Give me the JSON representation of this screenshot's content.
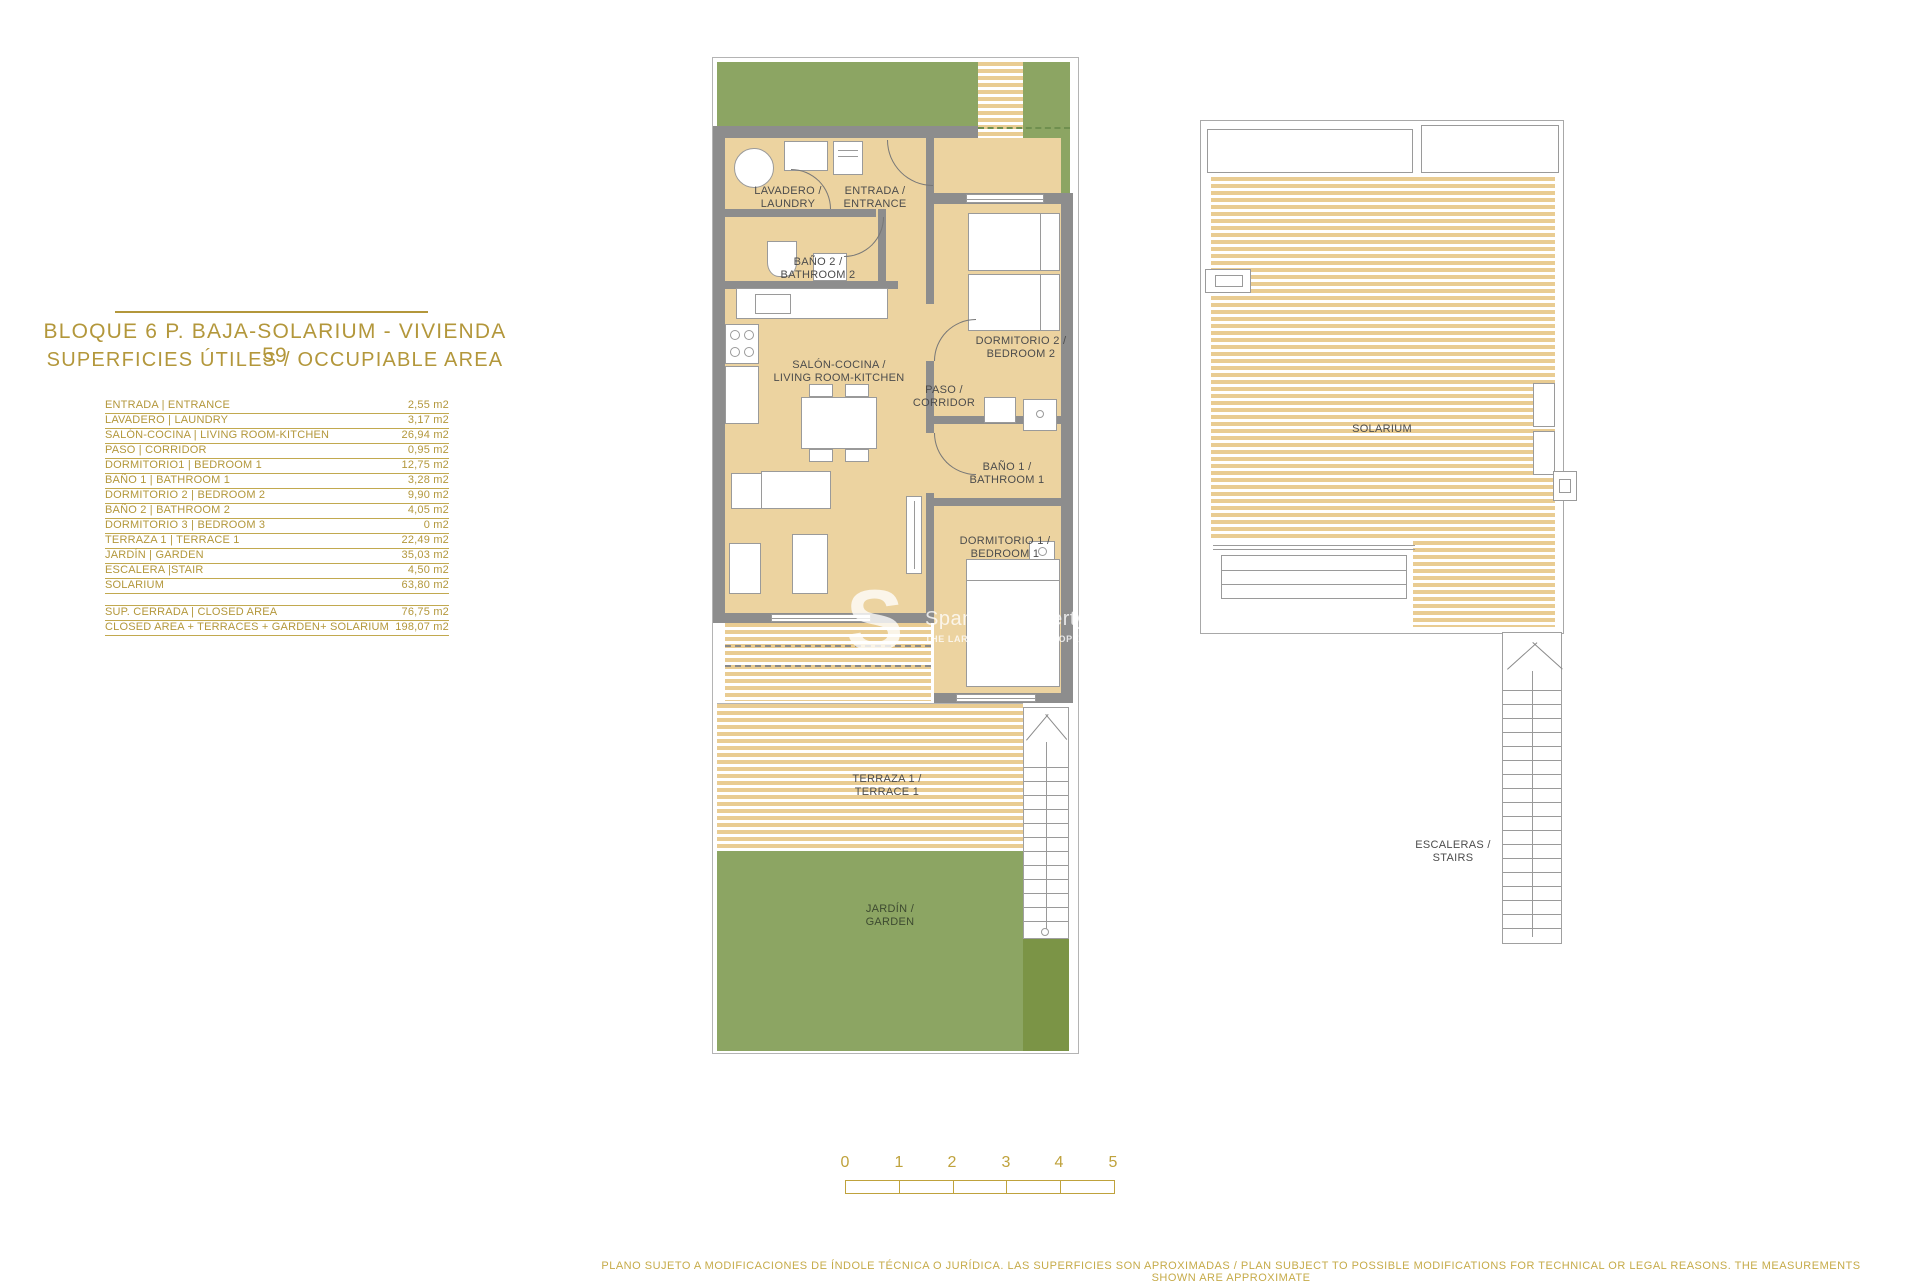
{
  "title_block": {
    "line1": "BLOQUE 6 P. BAJA-SOLARIUM - VIVIENDA 59",
    "line2": "SUPERFICIES ÚTILES / OCCUPIABLE AREA"
  },
  "area_table": {
    "rows": [
      {
        "label": "ENTRADA | ENTRANCE",
        "value": "2,55 m2"
      },
      {
        "label": "LAVADERO | LAUNDRY",
        "value": "3,17 m2"
      },
      {
        "label": "SALÓN-COCINA | LIVING ROOM-KITCHEN",
        "value": "26,94 m2"
      },
      {
        "label": "PASO | CORRIDOR",
        "value": "0,95 m2"
      },
      {
        "label": "DORMITORIO1 | BEDROOM 1",
        "value": "12,75 m2"
      },
      {
        "label": "BAÑO 1 | BATHROOM 1",
        "value": "3,28 m2"
      },
      {
        "label": "DORMITORIO 2 | BEDROOM 2",
        "value": "9,90 m2"
      },
      {
        "label": "BAÑO 2 | BATHROOM 2",
        "value": "4,05 m2"
      },
      {
        "label": "DORMITORIO 3 | BEDROOM 3",
        "value": "0 m2"
      },
      {
        "label": "TERRAZA 1 | TERRACE 1",
        "value": "22,49 m2"
      },
      {
        "label": "JARDÍN | GARDEN",
        "value": "35,03 m2"
      },
      {
        "label": "ESCALERA |STAIR",
        "value": "4,50 m2"
      },
      {
        "label": "SOLARIUM",
        "value": "63,80 m2"
      }
    ],
    "summary_rows": [
      {
        "label": "SUP. CERRADA | CLOSED AREA",
        "value": "76,75 m2"
      },
      {
        "label": "CLOSED AREA + TERRACES + GARDEN+ SOLARIUM",
        "value": "198,07 m2"
      }
    ]
  },
  "main_plan": {
    "rooms": {
      "laundry": "LAVADERO /\nLAUNDRY",
      "entrance": "ENTRADA /\nENTRANCE",
      "bathroom2": "BAÑO 2 /\nBATHROOM 2",
      "living": "SALÓN-COCINA /\nLIVING ROOM-KITCHEN",
      "corridor": "PASO /\nCORRIDOR",
      "bedroom2": "DORMITORIO 2 /\nBEDROOM 2",
      "bathroom1": "BAÑO 1 /\nBATHROOM 1",
      "bedroom1": "DORMITORIO 1 /\nBEDROOM 1",
      "terrace": "TERRAZA 1 /\nTERRACE 1",
      "garden": "JARDÍN /\nGARDEN"
    }
  },
  "solarium_plan": {
    "solarium": "SOLARIUM",
    "stairs": "ESCALERAS /\nSTAIRS"
  },
  "scale_bar": {
    "ticks": [
      "0",
      "1",
      "2",
      "3",
      "4",
      "5"
    ]
  },
  "watermark": {
    "initial": "S",
    "brand": "Spanish Property",
    "tagline": "THE LARGEST SPANISH PROPERTY LISTING"
  },
  "disclaimer": "PLANO SUJETO A MODIFICACIONES DE ÍNDOLE TÉCNICA O JURÍDICA. LAS SUPERFICIES SON APROXIMADAS / PLAN SUBJECT TO POSSIBLE MODIFICATIONS FOR TECHNICAL OR LEGAL REASONS. THE MEASUREMENTS SHOWN ARE APPROXIMATE",
  "colors": {
    "gold": "#b3973b",
    "tan_room": "#ecd3a0",
    "stripe_tan": "#e9cc92",
    "garden_green": "#8ca563",
    "dark_green": "#7b9446",
    "wall_gray": "#8d8d8d",
    "label_gray": "#4c4c4c"
  }
}
